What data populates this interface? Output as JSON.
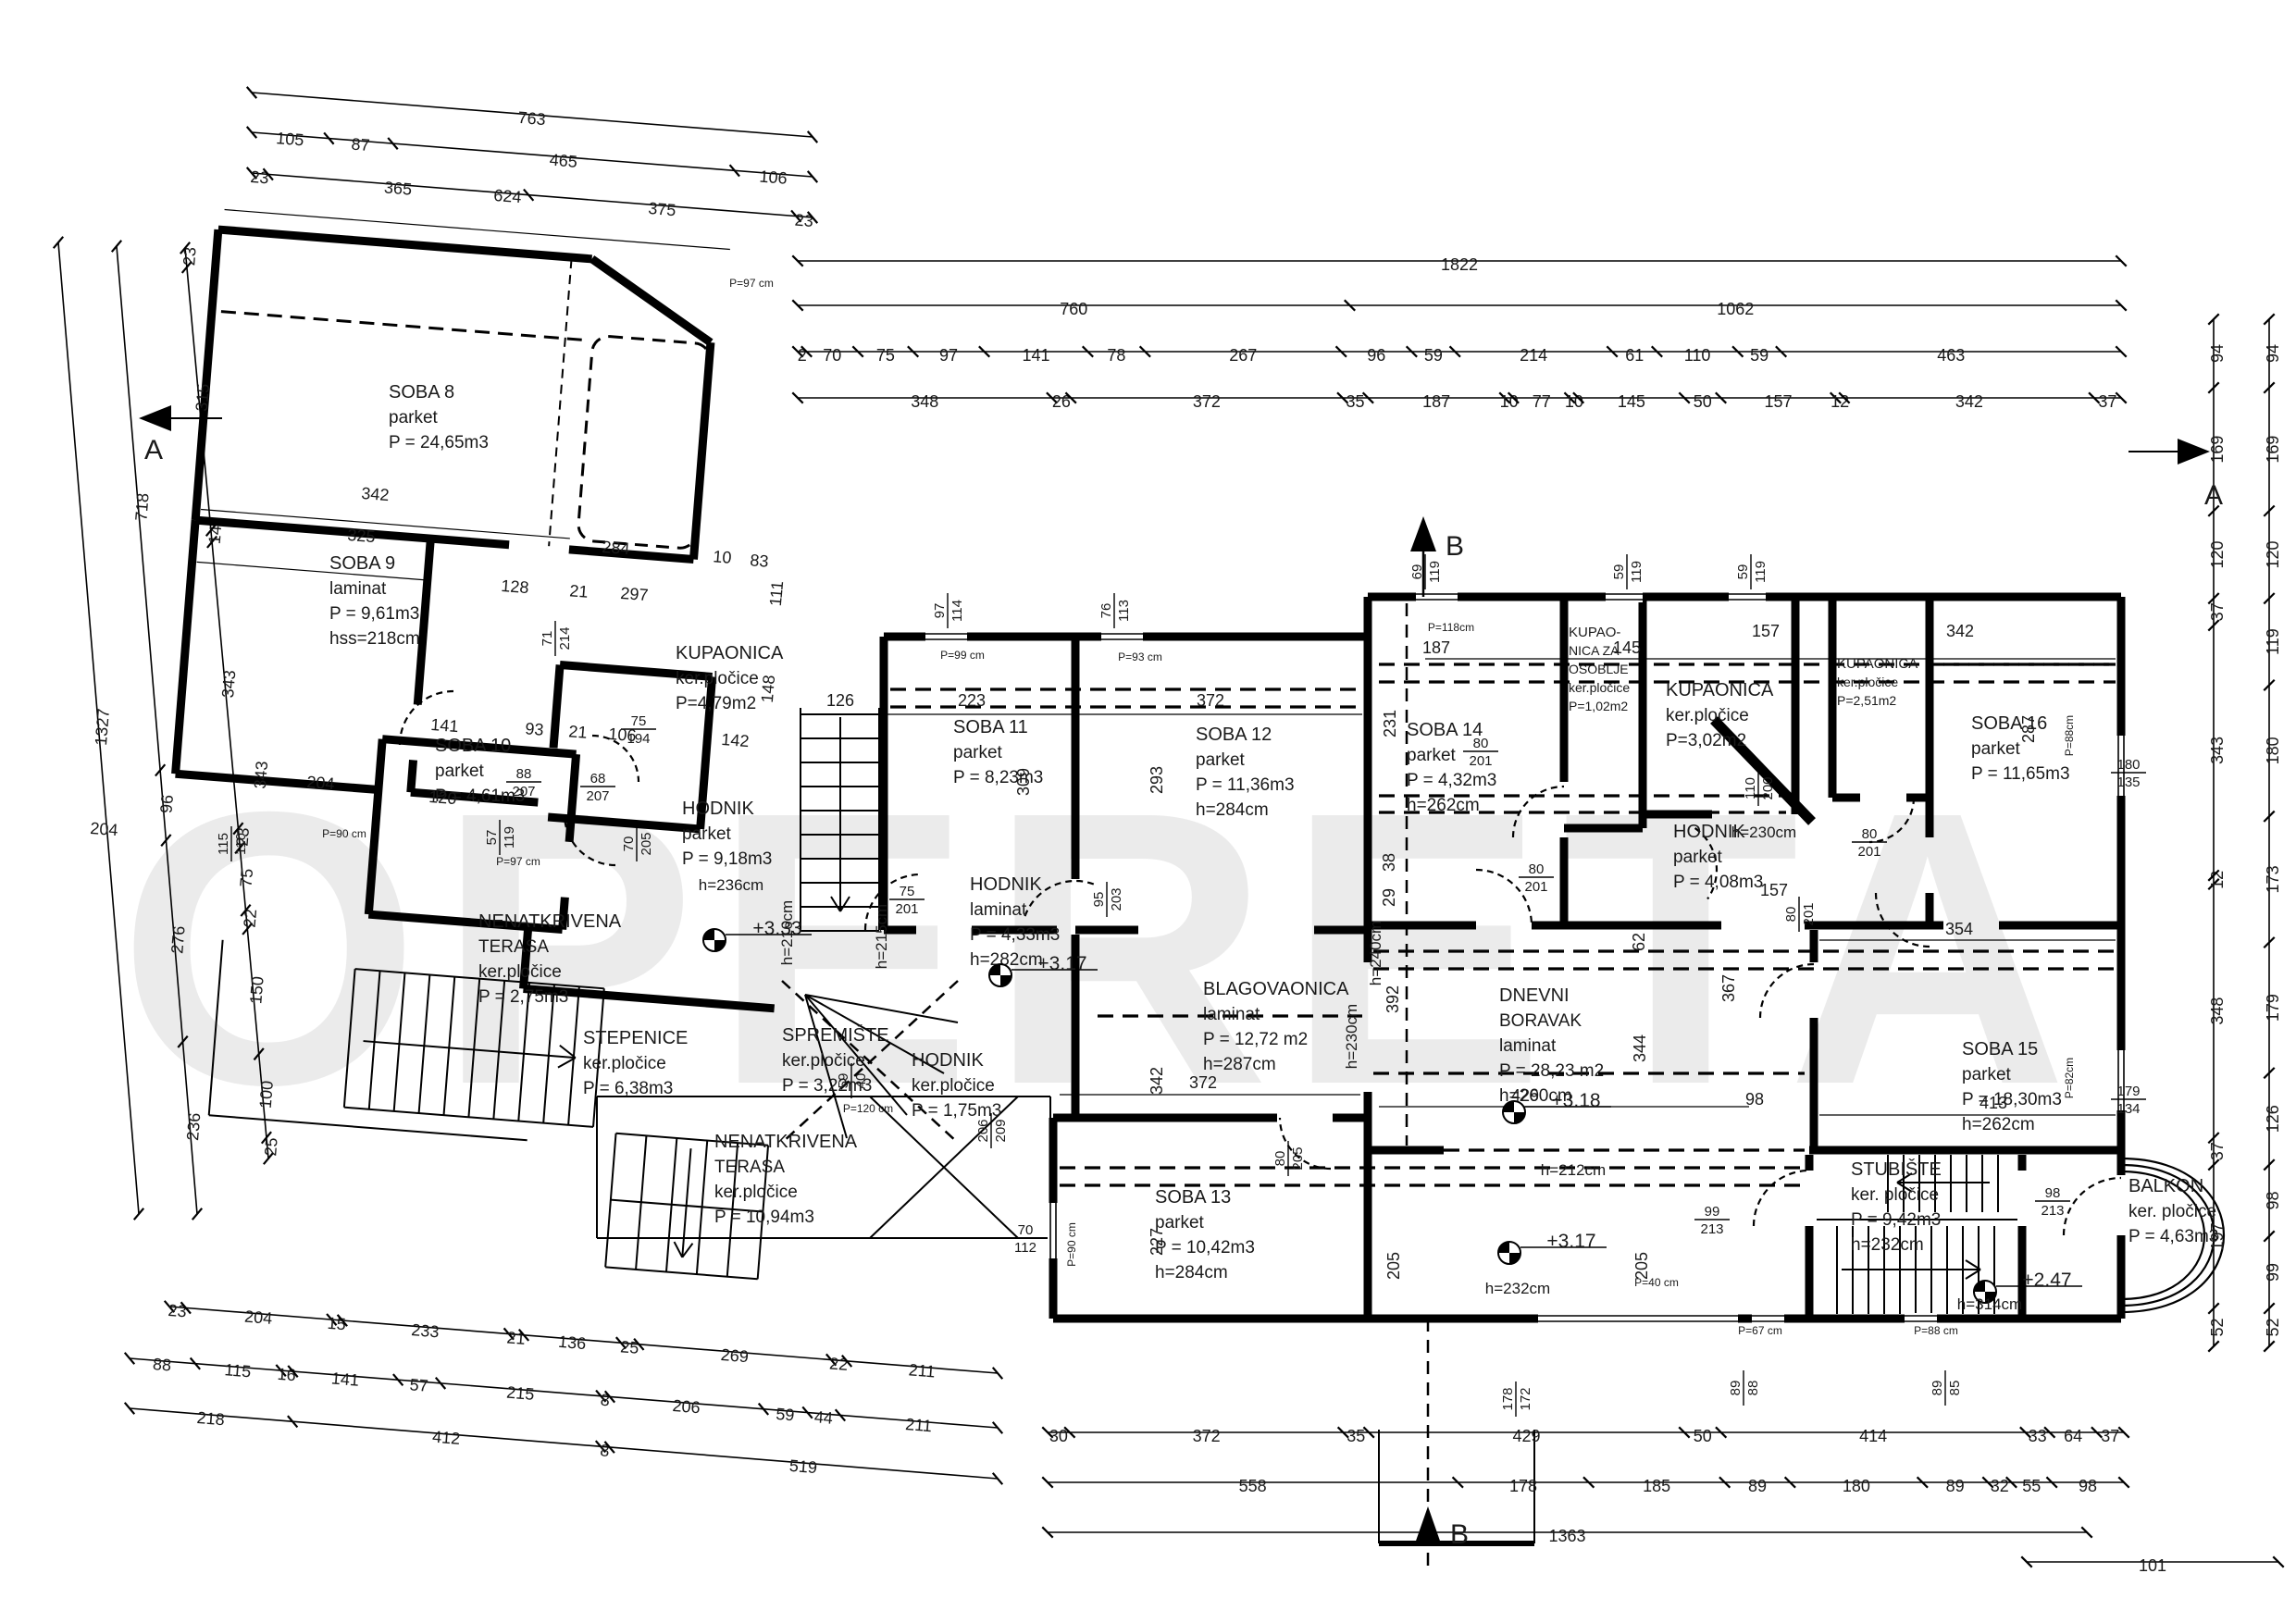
{
  "watermark": "OPERETA",
  "sections": {
    "a": "A",
    "b": "B"
  },
  "rooms": [
    {
      "lines": [
        "SOBA 8",
        "parket",
        "P = 24,65m3"
      ]
    },
    {
      "lines": [
        "SOBA 9",
        "laminat",
        "P = 9,61m3",
        "hss=218cm"
      ]
    },
    {
      "lines": [
        "SOBA 10",
        "parket",
        "P = 4,61m3"
      ]
    },
    {
      "lines": [
        "KUPAONICA",
        "ker.pločice",
        "P=4,79m2"
      ]
    },
    {
      "lines": [
        "HODNIK",
        "parket",
        "P = 9,18m3"
      ]
    },
    {
      "lines": [
        "NENATKRIVENA",
        "TERASA",
        "ker.pločice",
        "P = 2,75m3"
      ]
    },
    {
      "lines": [
        "STEPENICE",
        "ker.pločice",
        "P = 6,38m3"
      ]
    },
    {
      "lines": [
        "SPREMIŠTE",
        "ker.pločice",
        "P = 3,22m3"
      ]
    },
    {
      "lines": [
        "NENATKRIVENA",
        "TERASA",
        "ker.pločice",
        "P = 10,94m3"
      ]
    },
    {
      "lines": [
        "SOBA 11",
        "parket",
        "P = 8,23m3"
      ]
    },
    {
      "lines": [
        "HODNIK",
        "laminat",
        "P = 4,33m3",
        "h=282cm"
      ]
    },
    {
      "lines": [
        "HODNIK",
        "ker.pločice",
        "P = 1,75m3"
      ]
    },
    {
      "lines": [
        "SOBA 12",
        "parket",
        "P = 11,36m3",
        "h=284cm"
      ]
    },
    {
      "lines": [
        "BLAGOVAONICA",
        "laminat",
        "P = 12,72 m2",
        "h=287cm"
      ]
    },
    {
      "lines": [
        "SOBA 13",
        "parket",
        "P = 10,42m3",
        "h=284cm"
      ]
    },
    {
      "lines": [
        "SOBA 14",
        "parket",
        "P = 4,32m3",
        "h=262cm"
      ]
    },
    {
      "lines": [
        "KUPAO-",
        "NICA ZA",
        "OSOBLJE",
        "ker.pločice",
        "P=1,02m2"
      ]
    },
    {
      "lines": [
        "KUPAONICA",
        "ker.pločice",
        "P=3,02m2"
      ]
    },
    {
      "lines": [
        "KUPAONICA",
        "ker.pločice",
        "P=2,51m2"
      ]
    },
    {
      "lines": [
        "HODNIK",
        "parket",
        "P = 4,08m3"
      ]
    },
    {
      "lines": [
        "DNEVNI",
        "BORAVAK",
        "laminat",
        "P = 28,23 m2",
        "h=260cm"
      ]
    },
    {
      "lines": [
        "SOBA 15",
        "parket",
        "P = 18,30m3",
        "h=262cm"
      ]
    },
    {
      "lines": [
        "SOBA 16",
        "parket",
        "P = 11,65m3"
      ]
    },
    {
      "lines": [
        "STUBIŠTE",
        "ker. pločice",
        "P = 9,42m3",
        "h=232cm"
      ]
    },
    {
      "lines": [
        "BALKON",
        "ker. pločice",
        "P = 4,63m3"
      ]
    }
  ],
  "levels": [
    "+3.33",
    "+3.17",
    "+3.18",
    "+3.17",
    "+2.47"
  ],
  "heights": [
    "h=236cm",
    "h=216cm",
    "h=215cm",
    "h=240cm",
    "h=230cm",
    "h=212cm",
    "h=232cm",
    "h=314cm",
    "h=230cm"
  ],
  "window_labels": [
    "P=97 cm",
    "P=97 cm",
    "P=90 cm",
    "P=99 cm",
    "P=93 cm",
    "P=118cm",
    "P=88cm",
    "P=82cm",
    "P=40 cm",
    "P=67 cm",
    "P=88 cm",
    "P=120 cm",
    "P=90 cm"
  ],
  "fractions": [
    "71/214",
    "75/194",
    "88/207",
    "68/207",
    "70/205",
    "57/119",
    "75/201",
    "95/203",
    "206/209",
    "97/114",
    "76/113",
    "69/119",
    "59/119",
    "59/119",
    "80/201",
    "80/201",
    "80/201",
    "80/201",
    "110/200",
    "180/135",
    "179/134",
    "99/213",
    "98/213",
    "89/88",
    "89/85",
    "178/172",
    "70/112",
    "59/40",
    "80/205",
    "115/110"
  ],
  "interior_dims": [
    "624",
    "342",
    "284",
    "10",
    "83",
    "325",
    "343",
    "204",
    "120",
    "204",
    "141",
    "93",
    "21",
    "106",
    "142",
    "148",
    "111",
    "128",
    "21",
    "297",
    "126",
    "223",
    "372",
    "309",
    "293",
    "342",
    "372",
    "429",
    "98",
    "413",
    "157",
    "342",
    "287",
    "187",
    "145",
    "231",
    "157",
    "354",
    "367",
    "392",
    "344",
    "38",
    "29",
    "62",
    "205",
    "205",
    "227"
  ],
  "dims": {
    "tl1": [
      "763"
    ],
    "tl2": [
      "105",
      "87",
      "465",
      "106"
    ],
    "tl3": [
      "23",
      "365",
      "375",
      "23"
    ],
    "left1": [
      "1327"
    ],
    "left2": [
      "718",
      "96",
      "276",
      "236"
    ],
    "left3": [
      "23",
      "315",
      "14",
      "343",
      "23",
      "75",
      "22",
      "150",
      "100",
      "25"
    ],
    "bl1": [
      "23",
      "204",
      "15",
      "233",
      "21",
      "136",
      "25",
      "269",
      "22",
      "211"
    ],
    "bl2": [
      "88",
      "115",
      "16",
      "141",
      "57",
      "215",
      "8",
      "206",
      "59",
      "44",
      "211"
    ],
    "bl3": [
      "218",
      "412",
      "8",
      "519"
    ],
    "top1": [
      "1822"
    ],
    "top2": [
      "760",
      "1062"
    ],
    "top3": [
      "2",
      "70",
      "75",
      "97",
      "141",
      "78",
      "267",
      "96",
      "59",
      "214",
      "61",
      "110",
      "59",
      "463"
    ],
    "top4": [
      "348",
      "26",
      "372",
      "35",
      "187",
      "10",
      "77",
      "10",
      "145",
      "50",
      "157",
      "12",
      "342",
      "37"
    ],
    "right_inner": [
      "94",
      "169",
      "120",
      "37",
      "343",
      "12",
      "348",
      "37",
      "197",
      "52"
    ],
    "right_outer": [
      "94",
      "169",
      "120",
      "119",
      "180",
      "173",
      "179",
      "126",
      "98",
      "99",
      "52"
    ],
    "bottom1": [
      "30",
      "372",
      "35",
      "429",
      "50",
      "414",
      "33",
      "64",
      "37"
    ],
    "bottom2": [
      "558",
      "178",
      "185",
      "89",
      "180",
      "89",
      "32",
      "55",
      "98"
    ],
    "bottom3": [
      "1363"
    ],
    "bottom4": [
      "101"
    ]
  }
}
